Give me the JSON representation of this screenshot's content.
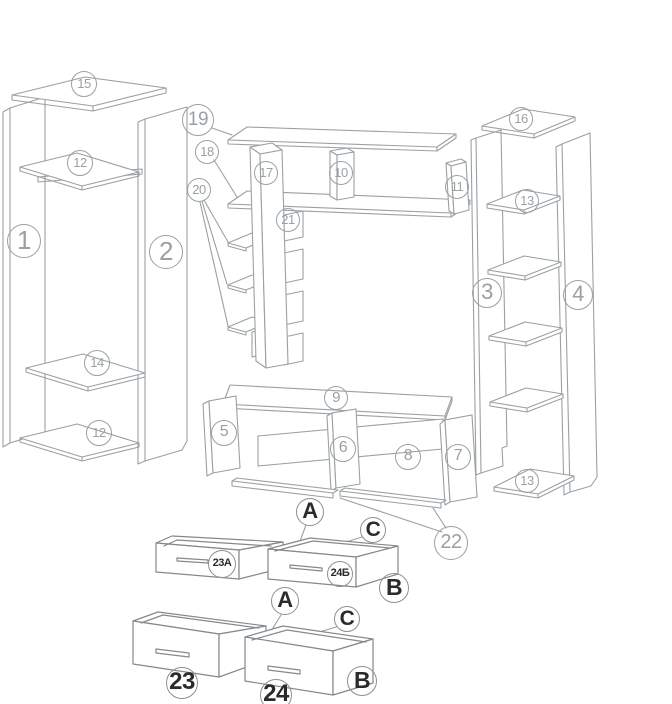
{
  "diagram_title": "",
  "colors": {
    "line": "#9aa0a4",
    "callout_number_text": "#9aa0a4",
    "label_text": "#2b2b2b",
    "background": "#ffffff"
  },
  "callouts": {
    "wardrobe": {
      "top_shelf": "15",
      "upper_shelf": "12",
      "left_side": "1",
      "right_side": "2",
      "middle_shelf": "14",
      "bottom_shelf": "12"
    },
    "wall_unit": {
      "top_shelf": "19",
      "long_shelf": "18",
      "step_shelves": "20",
      "upright": "17",
      "back_strips": "21",
      "divider_left": "10",
      "divider_right": "11"
    },
    "bookcase": {
      "top_shelf": "16",
      "upper_shelf": "13",
      "left_side": "3",
      "right_side": "4",
      "bottom_shelf": "13"
    },
    "tv_stand": {
      "top_panel": "9",
      "left_side": "5",
      "divider": "6",
      "back_panel": "8",
      "right_side": "7",
      "rails": "22"
    },
    "drawers_small": {
      "corner_a": "A",
      "corner_c": "C",
      "corner_b": "B",
      "left_label": "23A",
      "right_label": "24Б"
    },
    "drawers_large": {
      "corner_a": "A",
      "corner_c": "C",
      "corner_b": "B",
      "left_label": "23",
      "right_label": "24"
    }
  }
}
